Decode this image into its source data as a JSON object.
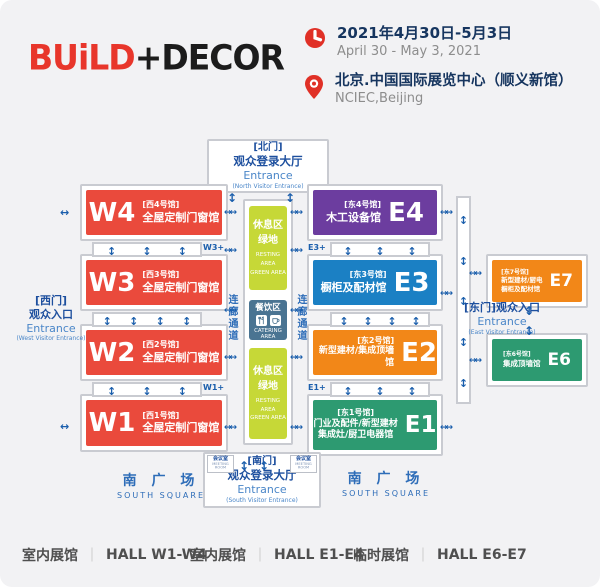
{
  "header": {
    "logo_build": "BUiLD",
    "logo_decor": "+DECOR",
    "date_zh": "2021年4月30日-5月3日",
    "date_en": "April 30 - May 3, 2021",
    "venue_zh": "北京.中国国际展览中心（顺义新馆）",
    "venue_en": "NCIEC,Beijing"
  },
  "colors": {
    "brand_red": "#e8362b",
    "hall_red": "#ea4a3c",
    "hall_purple": "#6c3d9f",
    "hall_blue": "#1b80c4",
    "hall_orange": "#f28718",
    "hall_green": "#2d9a71",
    "rest_lime": "#c6d837",
    "catering_slate": "#4a7492",
    "arrow_blue": "#1a5eac",
    "entrance_navy": "#1d4f9e"
  },
  "map": {
    "north": {
      "gate": "[北门]",
      "hall": "观众登录大厅",
      "en": "Entrance",
      "sub": "(North Visitor Entrance)"
    },
    "south": {
      "gate": "[南门]",
      "hall": "观众登录大厅",
      "en": "Entrance",
      "sub": "(South Visitor Entrance)"
    },
    "west": {
      "gate": "[西门]",
      "hall": "观众入口",
      "en": "Entrance",
      "sub": "(West Visitor Entrance)"
    },
    "east": {
      "gate": "[东门]观众入口",
      "en": "Entrance",
      "sub": "(East Visitor Entrance)"
    },
    "halls": {
      "w4": {
        "code": "W4",
        "tag": "[西4号馆]",
        "name": "全屋定制门窗馆"
      },
      "w3": {
        "code": "W3",
        "tag": "[西3号馆]",
        "name": "全屋定制门窗馆"
      },
      "w2": {
        "code": "W2",
        "tag": "[西2号馆]",
        "name": "全屋定制门窗馆"
      },
      "w1": {
        "code": "W1",
        "tag": "[西1号馆]",
        "name": "全屋定制门窗馆"
      },
      "e4": {
        "code": "E4",
        "tag": "[东4号馆]",
        "name": "木工设备馆"
      },
      "e3": {
        "code": "E3",
        "tag": "[东3号馆]",
        "name": "橱柜及配材馆"
      },
      "e2": {
        "code": "E2",
        "tag": "[东2号馆]",
        "name": "新型建材/集成顶墙馆"
      },
      "e1": {
        "code": "E1",
        "tag": "[东1号馆]",
        "name": "门业及配件/新型建材",
        "name2": "集成灶/厨卫电器馆"
      },
      "e7": {
        "code": "E7",
        "tag": "[东7号馆]",
        "name": "新型建材/厨电",
        "name2": "橱柜及配材馆"
      },
      "e6": {
        "code": "E6",
        "tag": "[东6号馆]",
        "name": "集成顶墙馆"
      }
    },
    "links": {
      "w3p": "W3+",
      "w1p": "W1+",
      "e3p": "E3+",
      "e1p": "E1+"
    },
    "rest": {
      "zh1": "休息区",
      "zh2": "绿地",
      "en1": "RESTING AREA",
      "en2": "GREEN AREA"
    },
    "catering": {
      "zh": "餐饮区",
      "en": "CATERING AREA"
    },
    "corridor": "连廊通道",
    "meeting": {
      "zh": "会议室",
      "en": "MEETING ROOM"
    },
    "square": {
      "zh": "南 广 场",
      "en": "SOUTH  SQUARE"
    }
  },
  "legend": [
    {
      "zh": "室内展馆",
      "en": "HALL W1-W4"
    },
    {
      "zh": "室内展馆",
      "en": "HALL E1-E4"
    },
    {
      "zh": "临时展馆",
      "en": "HALL E6-E7"
    }
  ]
}
